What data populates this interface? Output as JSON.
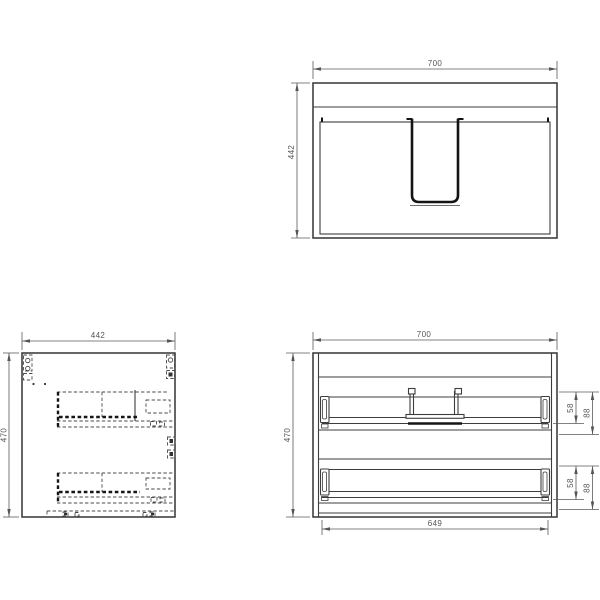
{
  "drawing": {
    "type": "vanity-cabinet-technical-drawing",
    "views": {
      "top": {
        "dims": {
          "width": "700",
          "depth": "442"
        }
      },
      "side": {
        "dims": {
          "width": "442",
          "height": "470"
        }
      },
      "front": {
        "dims": {
          "width": "700",
          "height": "470",
          "inner_width": "649",
          "upper_drawer_front": "58",
          "upper_drawer_total": "88",
          "lower_drawer_front": "58",
          "lower_drawer_total": "88"
        }
      }
    },
    "colors": {
      "line": "#3d3d3d",
      "thick_line": "#141414",
      "hidden_line": "#4a4a4a",
      "dim_line": "#5a5a5a",
      "dim_text": "#555555",
      "background": "#ffffff"
    }
  }
}
